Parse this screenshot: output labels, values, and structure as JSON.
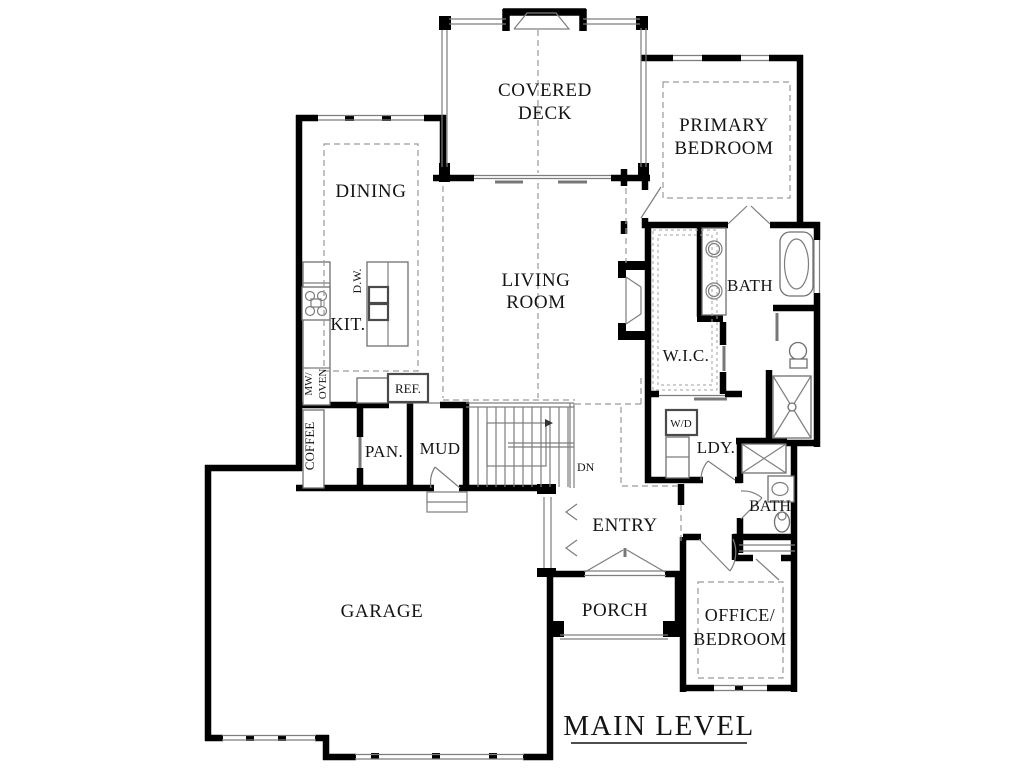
{
  "title": {
    "text": "MAIN LEVEL"
  },
  "rooms": {
    "covered_deck": {
      "line1": "COVERED",
      "line2": "DECK"
    },
    "primary_bedroom": {
      "line1": "PRIMARY",
      "line2": "BEDROOM"
    },
    "dining": {
      "label": "DINING"
    },
    "living_room": {
      "line1": "LIVING",
      "line2": "ROOM"
    },
    "kitchen": {
      "label": "KIT."
    },
    "primary_bath": {
      "label": "BATH"
    },
    "walk_in_closet": {
      "label": "W.I.C."
    },
    "laundry": {
      "label": "LDY."
    },
    "hall_bath": {
      "label": "BATH"
    },
    "office_bedroom": {
      "line1": "OFFICE/",
      "line2": "BEDROOM"
    },
    "entry": {
      "label": "ENTRY"
    },
    "porch": {
      "label": "PORCH"
    },
    "mud_room": {
      "label": "MUD"
    },
    "pantry": {
      "label": "PAN."
    },
    "garage": {
      "label": "GARAGE"
    }
  },
  "fixtures": {
    "dishwasher": "D.W.",
    "refrigerator": "REF.",
    "microwave": "MW/",
    "oven": "OVEN",
    "coffee_bar": "COFFEE",
    "washer_dryer": "W/D",
    "stairs_down": "DN"
  },
  "colors": {
    "walls": "#000000",
    "fixtures": "#7d7d7d",
    "dashed": "#9a9a9a",
    "background": "#ffffff",
    "text": "#141414"
  }
}
